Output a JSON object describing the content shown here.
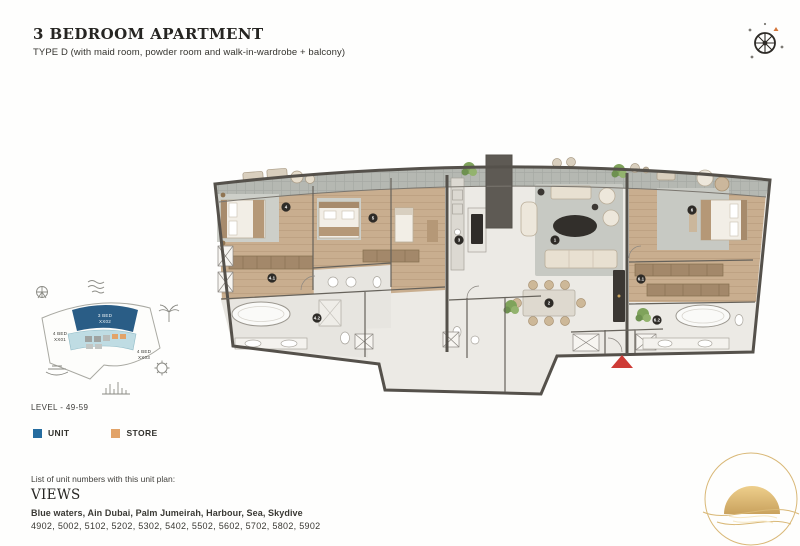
{
  "header": {
    "title": "3 BEDROOM APARTMENT",
    "subtitle": "TYPE D (with maid room, powder room and walk-in-wardrobe + balcony)"
  },
  "keyplan": {
    "highlight_unit": {
      "line1": "3 BED",
      "line2": "XX02"
    },
    "left_unit": {
      "line1": "4 BED",
      "line2": "XX01"
    },
    "right_unit": {
      "line1": "4 BED",
      "line2": "XX03"
    },
    "level_label": "LEVEL - 49-59",
    "colors": {
      "highlight": "#2A5D86",
      "light": "#BFDCE3",
      "outline": "#A9A9A2"
    }
  },
  "legend": {
    "unit_label": "UNIT",
    "unit_color": "#256C9F",
    "store_label": "STORE",
    "store_color": "#E2A368"
  },
  "footer": {
    "list_label": "List of unit numbers with this unit plan:",
    "views_title": "VIEWS",
    "views": "Blue waters, Ain Dubai, Palm Jumeirah, Harbour, Sea, Skydive",
    "unit_numbers": "4902, 5002, 5102, 5202, 5302, 5402, 5502, 5602, 5702, 5802, 5902"
  },
  "plan": {
    "badges": {
      "living": "1",
      "dining": "2",
      "kitchen": "3",
      "bedroom1": "4",
      "corridor": "4.1",
      "bathroom1": "4.2",
      "bedroom2": "5",
      "master": "6",
      "wardrobe": "6.1",
      "master_bath": "6.2"
    },
    "colors": {
      "entry": "#CE3B36",
      "wall": "#55514B",
      "wood": "#C9AE8F",
      "gold": "#C9A25E"
    }
  }
}
